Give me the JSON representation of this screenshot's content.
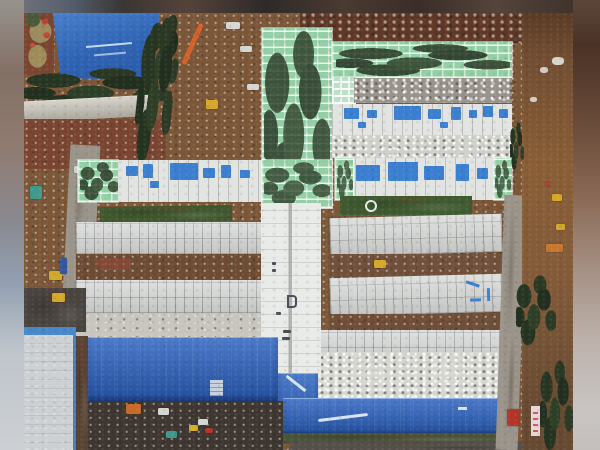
{
  "scene": {
    "type": "aerial-photograph",
    "description": "Drone aerial photo of a large modular hospital construction site on bare brown earth, pillarboxed with blurred edge strips",
    "areas": {
      "top_left": "blue tarp-covered sports field with faint lane lines, ringed by dark trees",
      "top_center": "mint-green roofed medical building complex with white grid seams and scattered trees on the roof",
      "upper_rows": "two long white buildings with bright blue wall panels and solar-blue windows",
      "middle": "parallel rows of white prefab container ward modules separated by dirt strips, joined by a bright white central corridor spine",
      "bottom_left": "large deep-blue metal roof warehouse",
      "bottom_center": "long deep-blue metal roof building with a white painted stripe",
      "left": "concrete staging slab, dark access road, construction machinery",
      "right": "muddy haul road and orange earth with diggers, trucks and a pink banner",
      "edges": "blurred letterbox strips on left, right and top"
    }
  },
  "palette": {
    "frame_bg": "#b9b2ac",
    "dirt_base": "#7b5738",
    "dirt_dark": "#5e3826",
    "dirt_red": "#7a4530",
    "mud_dark": "#3e3630",
    "green_roof": "#93cfa4",
    "green_roof_pale": "#bcdfc6",
    "grass": "#41582f",
    "grass_dark": "#3f5a30",
    "container_white": "#d2d4d2",
    "spine_white": "#e9ebe9",
    "white_bldg": "#e2e4e2",
    "concrete": "#ccd0d2",
    "road_gray": "#9a948a",
    "road_light": "#b5b1a8",
    "road_dark": "#4a4440",
    "rubble_gray": "#98928a",
    "rubble_light": "#cfd0ca",
    "blue_field": "#3a70c0",
    "blue_roof": "#2a60be",
    "blue_connector": "#2a62c0",
    "blue_window": "#3b7fd0",
    "blue_line": "#3a80cc",
    "blue_strip": "#4888c8",
    "machine_yellow": "#d4a828",
    "machine_orange": "#c96a28",
    "machine_teal": "#3f9a8c",
    "machine_red": "#b43428",
    "machine_green": "#8fae3c",
    "crane_orange": "#d2622a",
    "truck_white": "#d6d6d2",
    "banner_pink": "#e8d6d8",
    "paint_white": "#d8e4f2"
  }
}
